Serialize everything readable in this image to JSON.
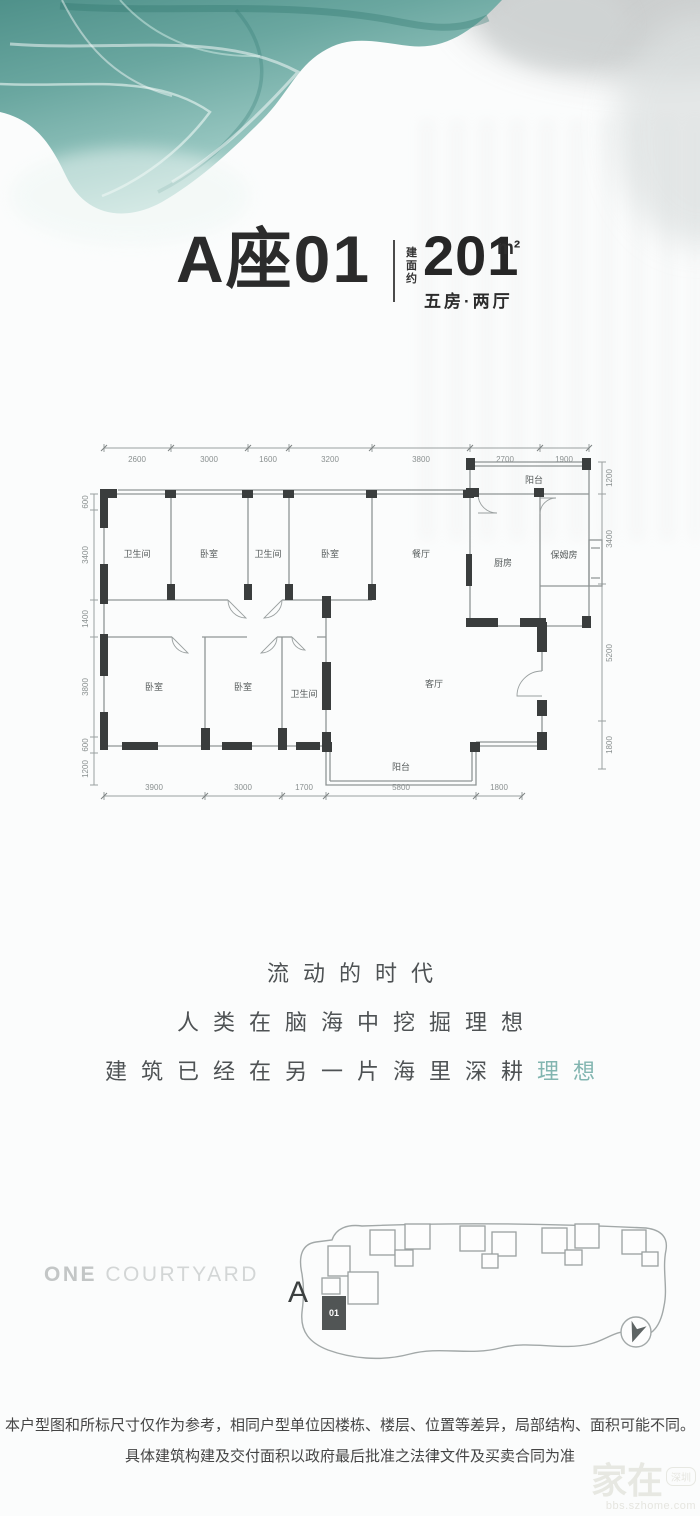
{
  "colors": {
    "teal": "#5d9d96",
    "slogan_accent": "#82b5b0",
    "ink": "#2b2b2b",
    "wall": "#3a3d3d",
    "line": "#8f9595"
  },
  "header": {
    "unit": "A座01",
    "area_label": "建面约",
    "area_value": "201",
    "area_unit": "m²",
    "layout": "五房·两厅"
  },
  "floorplan": {
    "dims_top": [
      "2600",
      "3000",
      "1600",
      "3200",
      "3800",
      "2700",
      "1900"
    ],
    "dims_bottom": [
      "3900",
      "3000",
      "1700",
      "5800",
      "1800"
    ],
    "dims_left": [
      "600",
      "3400",
      "1400",
      "3800",
      "600",
      "1200"
    ],
    "dims_right": [
      "1200",
      "3400",
      "5200",
      "1800"
    ],
    "rooms_upper": [
      "卫生间",
      "卧室",
      "卫生间",
      "卧室",
      "餐厅"
    ],
    "rooms_lower": [
      "卧室",
      "卧室",
      "卫生间",
      "客厅"
    ],
    "kitchen": "厨房",
    "maid": "保姆房",
    "balcony_top": "阳台",
    "balcony_bottom": "阳台"
  },
  "slogan": {
    "line1": "流动的时代",
    "line2": "人类在脑海中挖掘理想",
    "line3_prefix": "建筑已经在另一片海里深耕",
    "line3_accent": "理想"
  },
  "siteplan": {
    "brand_bold": "ONE",
    "brand_light": "COURTYARD",
    "block_label": "A",
    "unit_badge": "01"
  },
  "footer": {
    "line1": "本户型图和所标尺寸仅作为参考，相同户型单位因楼栋、楼层、位置等差异，局部结构、面积可能不同。",
    "line2": "具体建筑构建及交付面积以政府最后批准之法律文件及买卖合同为准"
  },
  "watermark": {
    "text": "家在",
    "badge": "深圳",
    "url": "bbs.szhome.com"
  }
}
